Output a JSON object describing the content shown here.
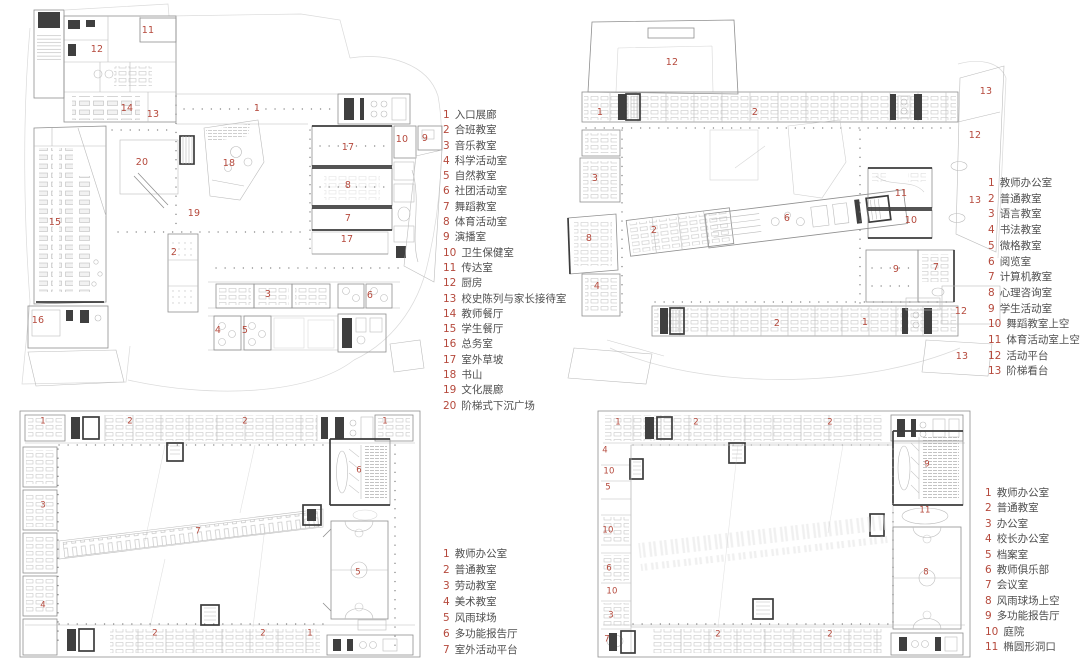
{
  "colors": {
    "label_red": "#b5493c",
    "legend_text": "#4f4f4f",
    "line_light": "#bcbcbc",
    "line_dark": "#3c3c3c",
    "background": "#ffffff"
  },
  "legends": {
    "floor1": {
      "items": [
        {
          "num": "1",
          "label": "入口展廊"
        },
        {
          "num": "2",
          "label": "合班教室"
        },
        {
          "num": "3",
          "label": "音乐教室"
        },
        {
          "num": "4",
          "label": "科学活动室"
        },
        {
          "num": "5",
          "label": "自然教室"
        },
        {
          "num": "6",
          "label": "社团活动室"
        },
        {
          "num": "7",
          "label": "舞蹈教室"
        },
        {
          "num": "8",
          "label": "体育活动室"
        },
        {
          "num": "9",
          "label": "演播室"
        },
        {
          "num": "10",
          "label": "卫生保健室"
        },
        {
          "num": "11",
          "label": "传达室"
        },
        {
          "num": "12",
          "label": "厨房"
        },
        {
          "num": "13",
          "label": "校史陈列与家长接待室"
        },
        {
          "num": "14",
          "label": "教师餐厅"
        },
        {
          "num": "15",
          "label": "学生餐厅"
        },
        {
          "num": "16",
          "label": "总务室"
        },
        {
          "num": "17",
          "label": "室外草坡"
        },
        {
          "num": "18",
          "label": "书山"
        },
        {
          "num": "19",
          "label": "文化展廊"
        },
        {
          "num": "20",
          "label": "阶梯式下沉广场"
        }
      ]
    },
    "floor2": {
      "items": [
        {
          "num": "1",
          "label": "教师办公室"
        },
        {
          "num": "2",
          "label": "普通教室"
        },
        {
          "num": "3",
          "label": "语言教室"
        },
        {
          "num": "4",
          "label": "书法教室"
        },
        {
          "num": "5",
          "label": "微格教室"
        },
        {
          "num": "6",
          "label": "阅览室"
        },
        {
          "num": "7",
          "label": "计算机教室"
        },
        {
          "num": "8",
          "label": "心理咨询室"
        },
        {
          "num": "9",
          "label": "学生活动室"
        },
        {
          "num": "10",
          "label": "舞蹈教室上空"
        },
        {
          "num": "11",
          "label": "体育活动室上空"
        },
        {
          "num": "12",
          "label": "活动平台"
        },
        {
          "num": "13",
          "label": "阶梯看台"
        }
      ]
    },
    "floor3": {
      "items": [
        {
          "num": "1",
          "label": "教师办公室"
        },
        {
          "num": "2",
          "label": "普通教室"
        },
        {
          "num": "3",
          "label": "劳动教室"
        },
        {
          "num": "4",
          "label": "美术教室"
        },
        {
          "num": "5",
          "label": "风雨球场"
        },
        {
          "num": "6",
          "label": "多功能报告厅"
        },
        {
          "num": "7",
          "label": "室外活动平台"
        }
      ]
    },
    "floor4": {
      "items": [
        {
          "num": "1",
          "label": "教师办公室"
        },
        {
          "num": "2",
          "label": "普通教室"
        },
        {
          "num": "3",
          "label": "办公室"
        },
        {
          "num": "4",
          "label": "校长办公室"
        },
        {
          "num": "5",
          "label": "档案室"
        },
        {
          "num": "6",
          "label": "教师俱乐部"
        },
        {
          "num": "7",
          "label": "会议室"
        },
        {
          "num": "8",
          "label": "风雨球场上空"
        },
        {
          "num": "9",
          "label": "多功能报告厅"
        },
        {
          "num": "10",
          "label": "庭院"
        },
        {
          "num": "11",
          "label": "椭圆形洞口"
        }
      ]
    }
  },
  "plans": {
    "floor1": {
      "labels": [
        {
          "t": "11",
          "x": 140,
          "y": 31
        },
        {
          "t": "12",
          "x": 89,
          "y": 50
        },
        {
          "t": "1",
          "x": 249,
          "y": 109
        },
        {
          "t": "14",
          "x": 119,
          "y": 109
        },
        {
          "t": "13",
          "x": 145,
          "y": 115
        },
        {
          "t": "10",
          "x": 394,
          "y": 140
        },
        {
          "t": "9",
          "x": 417,
          "y": 139
        },
        {
          "t": "17",
          "x": 340,
          "y": 148
        },
        {
          "t": "20",
          "x": 134,
          "y": 163
        },
        {
          "t": "18",
          "x": 221,
          "y": 164
        },
        {
          "t": "8",
          "x": 340,
          "y": 186
        },
        {
          "t": "19",
          "x": 186,
          "y": 214
        },
        {
          "t": "7",
          "x": 340,
          "y": 219
        },
        {
          "t": "15",
          "x": 47,
          "y": 223
        },
        {
          "t": "17",
          "x": 339,
          "y": 240
        },
        {
          "t": "2",
          "x": 166,
          "y": 253
        },
        {
          "t": "3",
          "x": 260,
          "y": 295
        },
        {
          "t": "6",
          "x": 362,
          "y": 296
        },
        {
          "t": "16",
          "x": 30,
          "y": 321
        },
        {
          "t": "4",
          "x": 210,
          "y": 331
        },
        {
          "t": "5",
          "x": 237,
          "y": 331
        }
      ]
    },
    "floor2": {
      "labels": [
        {
          "t": "12",
          "x": 112,
          "y": 45
        },
        {
          "t": "13",
          "x": 426,
          "y": 74
        },
        {
          "t": "1",
          "x": 40,
          "y": 95
        },
        {
          "t": "2",
          "x": 195,
          "y": 95
        },
        {
          "t": "12",
          "x": 415,
          "y": 118
        },
        {
          "t": "3",
          "x": 35,
          "y": 161
        },
        {
          "t": "11",
          "x": 341,
          "y": 176
        },
        {
          "t": "13",
          "x": 415,
          "y": 183
        },
        {
          "t": "6",
          "x": 227,
          "y": 201
        },
        {
          "t": "10",
          "x": 351,
          "y": 203
        },
        {
          "t": "2",
          "x": 94,
          "y": 213
        },
        {
          "t": "8",
          "x": 29,
          "y": 221
        },
        {
          "t": "9",
          "x": 336,
          "y": 252
        },
        {
          "t": "7",
          "x": 376,
          "y": 250
        },
        {
          "t": "4",
          "x": 37,
          "y": 269
        },
        {
          "t": "12",
          "x": 401,
          "y": 294
        },
        {
          "t": "1",
          "x": 305,
          "y": 305
        },
        {
          "t": "2",
          "x": 217,
          "y": 306
        },
        {
          "t": "13",
          "x": 402,
          "y": 339
        }
      ]
    },
    "floor3": {
      "labels": [
        {
          "t": "1",
          "x": 28,
          "y": 19
        },
        {
          "t": "2",
          "x": 115,
          "y": 19
        },
        {
          "t": "2",
          "x": 230,
          "y": 19
        },
        {
          "t": "1",
          "x": 370,
          "y": 19
        },
        {
          "t": "6",
          "x": 344,
          "y": 68
        },
        {
          "t": "3",
          "x": 28,
          "y": 103
        },
        {
          "t": "7",
          "x": 183,
          "y": 129
        },
        {
          "t": "5",
          "x": 343,
          "y": 170
        },
        {
          "t": "4",
          "x": 28,
          "y": 203
        },
        {
          "t": "2",
          "x": 140,
          "y": 231
        },
        {
          "t": "2",
          "x": 248,
          "y": 231
        },
        {
          "t": "1",
          "x": 295,
          "y": 231
        }
      ]
    },
    "floor4": {
      "labels": [
        {
          "t": "1",
          "x": 25,
          "y": 20
        },
        {
          "t": "2",
          "x": 103,
          "y": 20
        },
        {
          "t": "2",
          "x": 237,
          "y": 20
        },
        {
          "t": "4",
          "x": 12,
          "y": 48
        },
        {
          "t": "9",
          "x": 334,
          "y": 62
        },
        {
          "t": "10",
          "x": 16,
          "y": 69
        },
        {
          "t": "5",
          "x": 15,
          "y": 85
        },
        {
          "t": "11",
          "x": 332,
          "y": 108
        },
        {
          "t": "10",
          "x": 15,
          "y": 128
        },
        {
          "t": "6",
          "x": 16,
          "y": 166
        },
        {
          "t": "8",
          "x": 333,
          "y": 170
        },
        {
          "t": "10",
          "x": 19,
          "y": 189
        },
        {
          "t": "3",
          "x": 18,
          "y": 213
        },
        {
          "t": "2",
          "x": 125,
          "y": 232
        },
        {
          "t": "2",
          "x": 237,
          "y": 232
        },
        {
          "t": "7",
          "x": 14,
          "y": 237
        }
      ]
    }
  }
}
